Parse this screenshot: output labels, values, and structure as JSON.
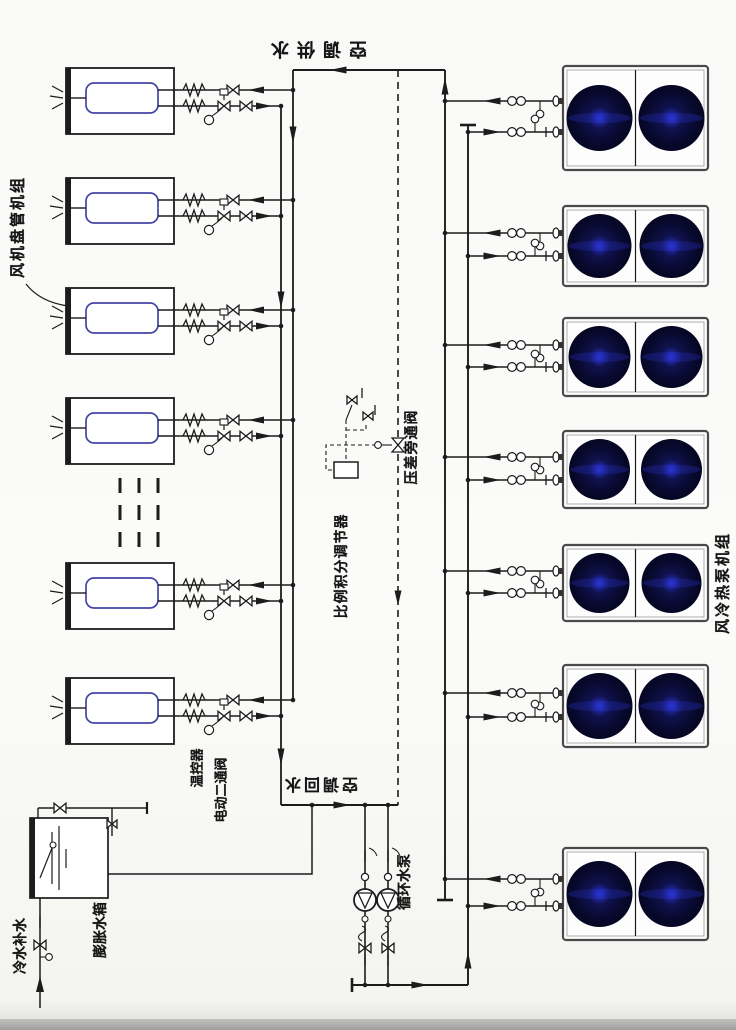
{
  "diagram": {
    "title": "空调水系统原理图",
    "labels": {
      "fan_coil_group": "风机盘管机组",
      "heat_pump_group": "风冷热泵机组",
      "supply_water": "空调供水",
      "return_water": "空调回水",
      "thermostat": "温控器",
      "electric_two_way_valve": "电动二通阀",
      "pi_controller": "比例积分调节器",
      "pressure_bypass_valve": "压差旁通阀",
      "circulating_pump": "循环水泵",
      "expansion_tank": "膨胀水箱",
      "makeup_water": "冷水补水"
    },
    "counts": {
      "fan_coil_units": 6,
      "heat_pump_units": 7,
      "fans_per_heat_pump": 2,
      "circulating_pumps": 2
    },
    "colors": {
      "line": "#1c1c1c",
      "coil_outline": "#4444a8",
      "fan_dark": "#08092e",
      "fan_mid": "#10124e",
      "fan_glow": "#2b35d8",
      "frame": "#4a4a4a",
      "background": "#f9f9f7",
      "photo_edge": "#a5a5a3"
    }
  }
}
